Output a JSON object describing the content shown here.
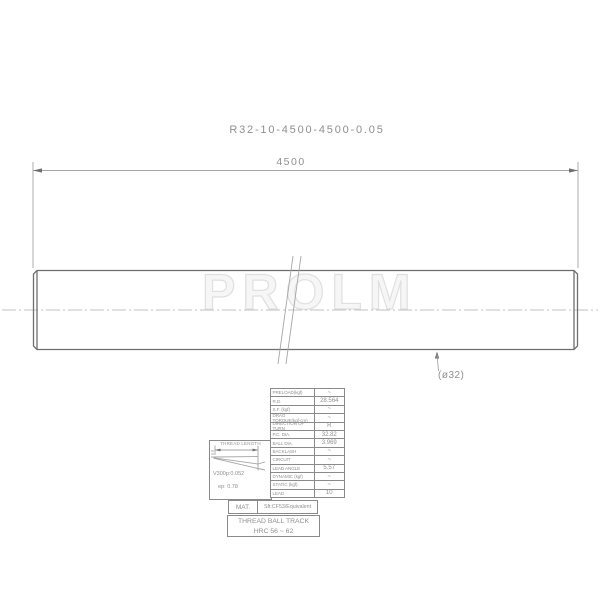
{
  "title": "R32-10-4500-4500-0.05",
  "dimensions": {
    "overall_length": "4500",
    "diameter_callout": "(ø32)"
  },
  "watermark": "PROLM",
  "detail": {
    "heading": "THREAD LENGTH",
    "v300": "V300p:0.052",
    "ep": "ep: 0.78"
  },
  "spec_table": {
    "rows": [
      {
        "label": "PRELOAD(kgf)",
        "value": "~"
      },
      {
        "label": "R.D.",
        "value": "28.564"
      },
      {
        "label": "S.F. (kgf)",
        "value": "~"
      },
      {
        "label": "DRAG TORQUE(kgf-cm)",
        "value": "~"
      },
      {
        "label": "DIRECTION OF TURN",
        "value": "R"
      },
      {
        "label": "P.C. DIA.",
        "value": "32.82"
      },
      {
        "label": "BALL DIA.",
        "value": "3.969"
      },
      {
        "label": "BACKLASH",
        "value": "~"
      },
      {
        "label": "CIRCUIT",
        "value": "~"
      },
      {
        "label": "LEAD ANGLE",
        "value": "5.57"
      },
      {
        "label": "DYNAMIC (kgf)",
        "value": "~"
      },
      {
        "label": "STATIC (kgf)",
        "value": "~"
      },
      {
        "label": "LEAD",
        "value": "10"
      }
    ]
  },
  "material": {
    "label": "MAT.",
    "value": "Sft:CF53/Equivalent"
  },
  "hardness": {
    "line1": "THREAD BALL TRACK",
    "line2": "HRC 56 ~ 62"
  },
  "colors": {
    "line": "#6e6e6e",
    "thin": "#a5a5a5",
    "text": "#8f8f8f",
    "table": "#8a8a8a",
    "wm": "#e0e0e0",
    "center": "#c2c2c2"
  }
}
